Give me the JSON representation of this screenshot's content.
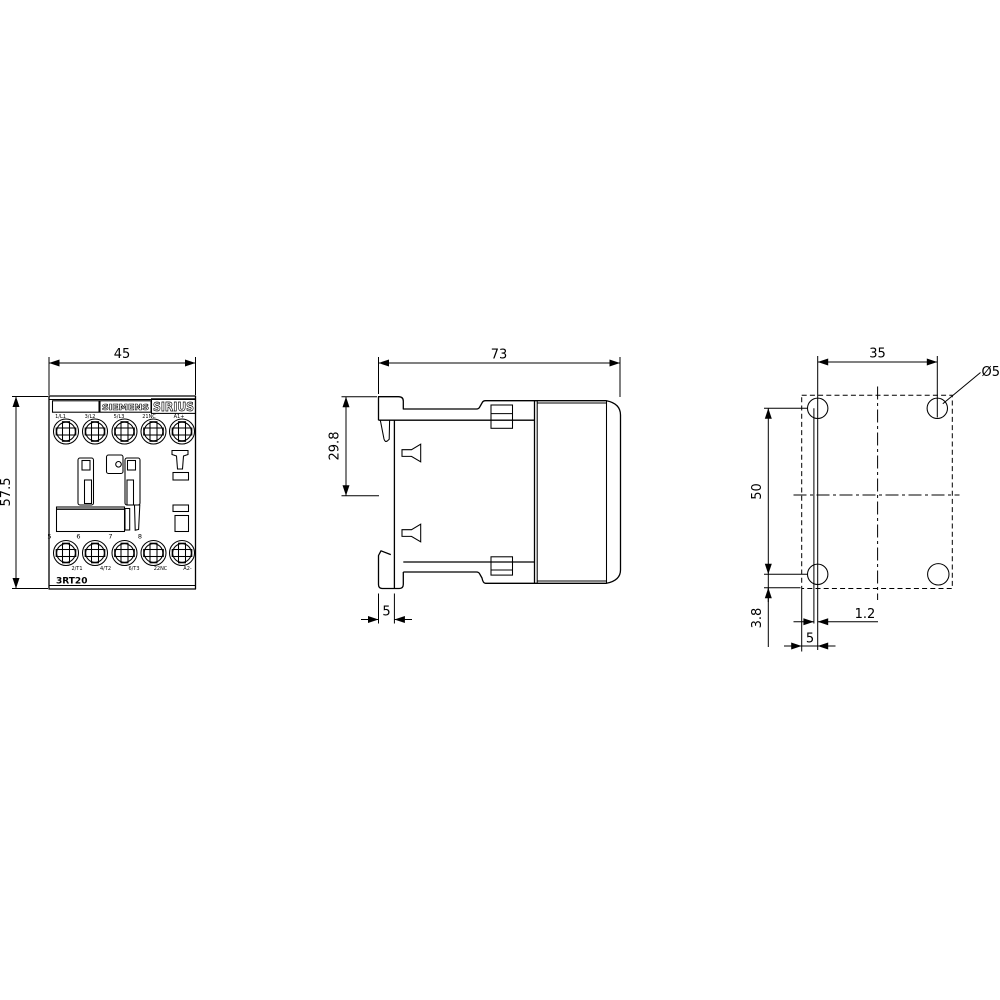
{
  "front_view": {
    "width_dim": "45",
    "height_dim": "57.5",
    "brand": "SIEMENS",
    "series": "SIRIUS",
    "model": "3RT20",
    "top_terminal_labels": [
      "1/L1",
      "3/L2",
      "5/L3",
      "21NC",
      "A1+"
    ],
    "bottom_terminal_labels": [
      "2/T1",
      "4/T2",
      "6/T3",
      "22NC",
      "A2-"
    ],
    "position_numbers": [
      "5",
      "6",
      "7",
      "8"
    ]
  },
  "side_view": {
    "depth_dim": "73",
    "din_offset_dim": "29.8",
    "plate_thickness_dim": "5"
  },
  "mounting_view": {
    "hole_spacing_horizontal": "35",
    "hole_spacing_vertical": "50",
    "hole_diameter": "Ø5",
    "hole_edge_offset_vertical": "3.8",
    "rail_offset": "1.2",
    "hole_edge_offset_horizontal": "5"
  },
  "colors": {
    "line": "#000000",
    "background": "#ffffff"
  }
}
